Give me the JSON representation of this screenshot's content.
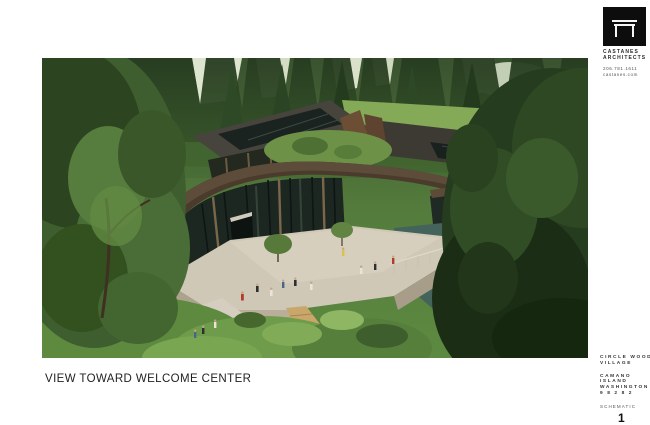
{
  "sheet": {
    "background": "#ffffff",
    "caption": "VIEW TOWARD WELCOME CENTER",
    "sheet_number": "1"
  },
  "rendering": {
    "description": "Aerial rendering of a curved glass welcome center with green roof courtyard, concrete plaza with visitors, pond, boardwalk and surrounding evergreen forest"
  },
  "logo_block": {
    "icon": "arch-table-logo-icon",
    "firm_line1": "CASTANES",
    "firm_line2": "ARCHITECTS",
    "phone": "206.781.1611",
    "website": "castanes.com"
  },
  "title_block": {
    "project_line1": "CIRCLE WOOD",
    "project_line2": "VILLAGE",
    "location_line1": "CAMANO",
    "location_line2": "ISLAND",
    "location_line3": "WASHINGTON",
    "location_line4": "9 8 2 8 2",
    "phase": "SCHEMATIC",
    "sheet_number": "1"
  },
  "palette": {
    "forest_dark": "#24391d",
    "forest_mid": "#3c5a2c",
    "foliage_bright": "#7aa451",
    "roof_brown": "#46382a",
    "glass_dark": "#1d2722",
    "concrete": "#cfc8b6",
    "boardwalk": "#c9a76b",
    "water": "#44635a",
    "sky": "#dfe7d2",
    "logo_black": "#0d0d0d"
  }
}
